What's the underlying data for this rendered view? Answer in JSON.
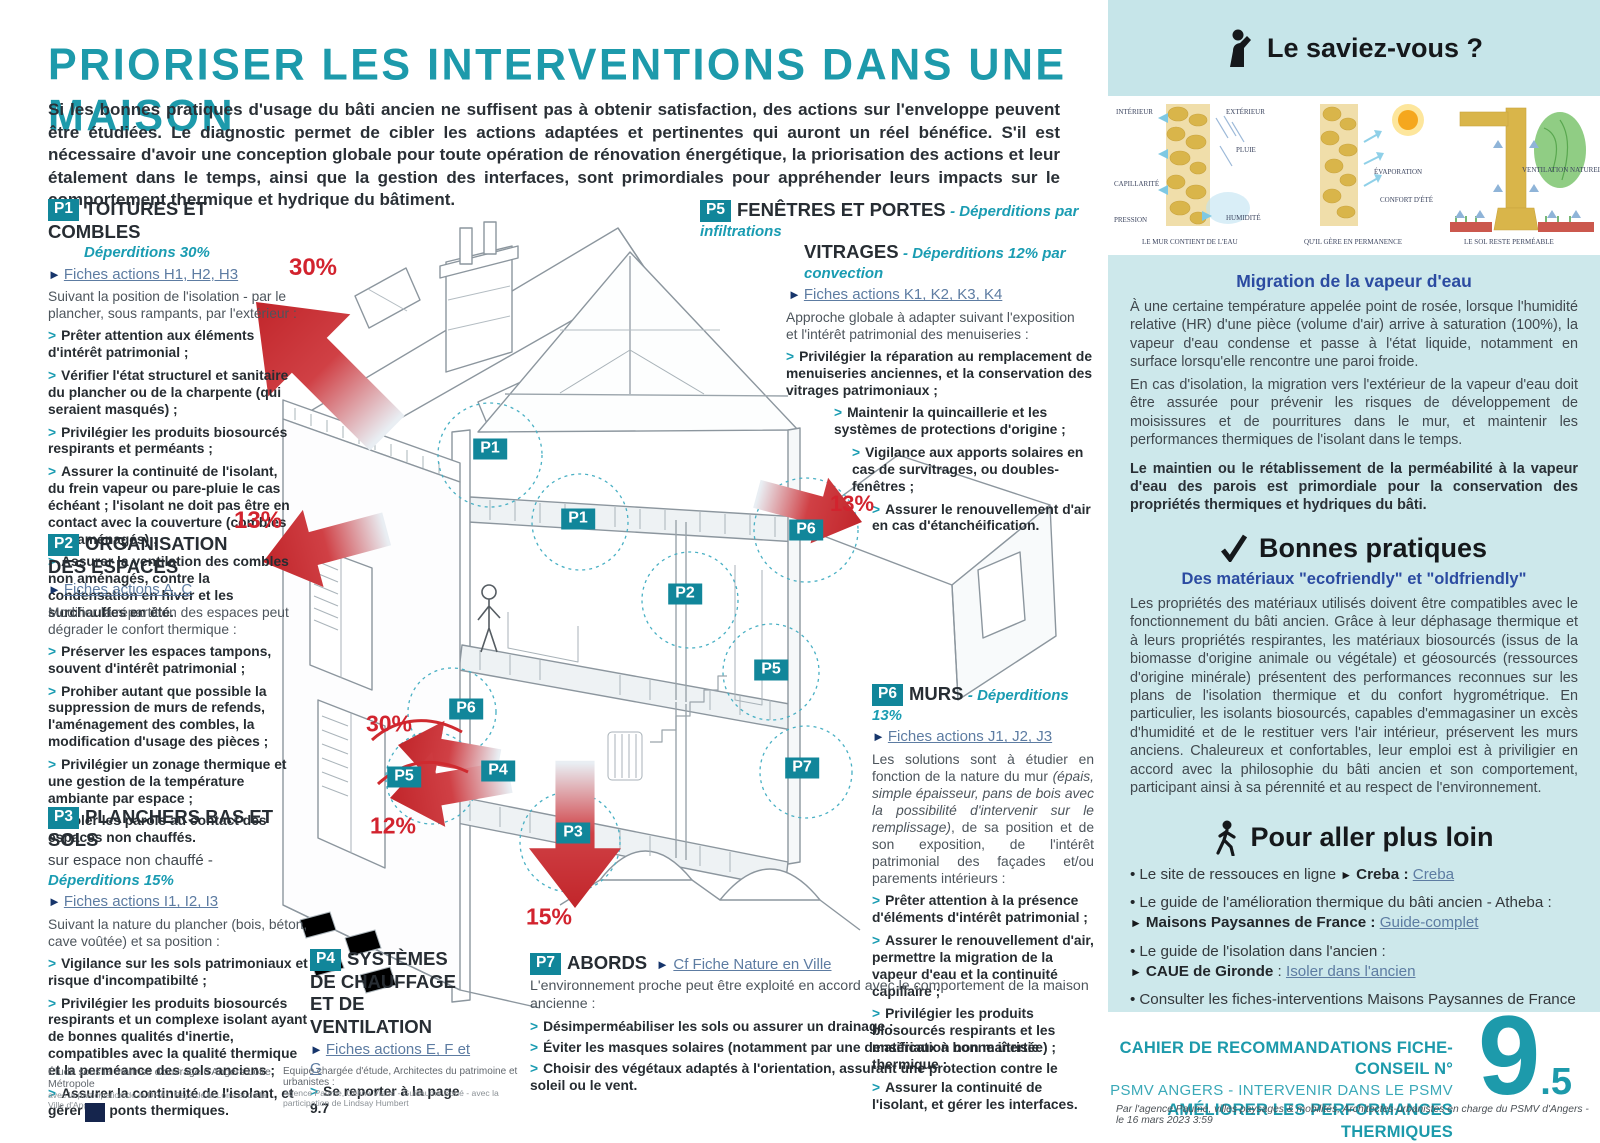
{
  "header": {
    "title": "PRIORISER LES INTERVENTIONS DANS UNE MAISON",
    "intro": "Si les bonnes pratiques d'usage du bâti ancien ne suffisent pas à obtenir satisfaction, des actions sur l'enveloppe peuvent être étudiées. Le diagnostic permet de cibler les actions adaptées et pertinentes qui auront un réel bénéfice. S'il est nécessaire d'avoir une conception globale pour toute opération de rénovation énergétique, la priorisation des actions et leur étalement dans le temps, ainsi que la gestion des interfaces, sont primordiales pour appréhender leurs impacts sur le comportement thermique et hydrique du bâtiment."
  },
  "sections": {
    "p1": {
      "badge": "P1",
      "title": "TOITURES ET COMBLES",
      "subtitle": "Déperditions 30%",
      "link": "Fiches actions H1, H2, H3",
      "lead": "Suivant la position de l'isolation - par le plancher, sous rampants, par l'extérieur :",
      "bullets": [
        "Prêter attention aux éléments d'intérêt patrimonial ;",
        "Vérifier l'état structurel et sanitaire du plancher ou de la charpente (qui seraient masqués) ;",
        "Privilégier les produits biosourcés respirants et perméants ;",
        "Assurer la continuité de l'isolant, du frein vapeur ou pare-pluie le cas échéant ; l'isolant ne doit pas être en contact avec la couverture (combles non aménagés) ;",
        "Assurer la ventilation des combles non aménagés, contre la condensation en hiver et les surchauffes en été."
      ]
    },
    "p2": {
      "badge": "P2",
      "title": "ORGANISATION DES ESPACES",
      "link": "Fiches actions A, C",
      "lead": "Modifier la répartition des espaces peut dégrader le confort thermique :",
      "bullets": [
        "Préserver les espaces tampons, souvent d'intérêt patrimonial ;",
        "Prohiber autant que possible la suppression de murs de refends, l'aménagement des combles, la modification d'usage des pièces ;",
        "Privilégier un zonage thermique et une gestion de la température ambiante par espace ;",
        "Isoler les parois au contact des espaces non chauffés."
      ]
    },
    "p3": {
      "badge": "P3",
      "title": "PLANCHERS BAS ET SOLS",
      "subtitle_plain": "sur espace non chauffé - ",
      "subtitle": "Déperditions 15%",
      "link": "Fiches actions I1, I2, I3",
      "lead": "Suivant la nature du plancher (bois, béton, cave voûtée) et sa position :",
      "bullets": [
        "Vigilance sur les sols patrimoniaux et risque d'incompatibilté ;",
        "Privilégier les produits biosourcés respirants et un complexe isolant ayant de bonnes qualités d'inertie, compatibles avec la qualité thermique et la perméance des sols anciens ;",
        "Assurer la continuité de l'isolant, et gérer les ponts thermiques."
      ]
    },
    "p4": {
      "badge": "P4",
      "title": "SYSTÈMES DE CHAUFFAGE ET DE VENTILATION",
      "link": "Fiches actions E, F et G",
      "bullets": [
        "Se reporter à la page 9.7"
      ]
    },
    "p5": {
      "badge": "P5",
      "title": "FENÊTRES ET PORTES",
      "subtitle": "- Déperditions par infiltrations",
      "title2": "VITRAGES",
      "subtitle2": "- Déperditions 12% par convection",
      "link": "Fiches actions K1, K2, K3, K4",
      "lead": "Approche globale à adapter suivant l'exposition et l'intérêt patrimonial des menuiseries :",
      "bullets": [
        "Privilégier la réparation au remplacement de menuiseries anciennes, et la conservation des vitrages patrimoniaux ;",
        "Maintenir la quincaillerie et les systèmes de protections d'origine ;",
        "Vigilance aux apports solaires en cas de survitrages, ou doubles-fenêtres ;",
        "Assurer le renouvellement d'air en cas d'étanchéification."
      ]
    },
    "p6": {
      "badge": "P6",
      "title": "MURS",
      "subtitle": "- Déperditions 13%",
      "link": "Fiches actions J1, J2, J3",
      "lead_pre": "Les solutions sont à étudier en fonction de la nature du mur ",
      "lead_italic": "(épais, simple épaisseur, pans de bois avec la possibilité d'intervenir sur le remplissage)",
      "lead_post": ", de sa position et de son exposition, de l'intérêt patrimonial des façades et/ou parements intérieurs :",
      "bullets": [
        "Prêter attention à la présence d'éléments d'intérêt patrimonial ;",
        "Assurer le renouvellement d'air, permettre la migration de la vapeur d'eau et la continuité capillaire ;",
        "Privilégier les produits biosourcés respirants et les matériaux à bonne inertie thermique ;",
        "Assurer la continuité de l'isolant, et gérer les interfaces."
      ]
    },
    "p7": {
      "badge": "P7",
      "title": "ABORDS",
      "link": "Cf Fiche Nature en Ville",
      "lead": "L'environnement proche peut être exploité en accord avec le comportement de la maison ancienne :",
      "bullets": [
        "Désimperméabiliser les sols ou assurer un drainage ;",
        "Éviter les masques solaires (notamment par une densification non maîtrisée) ;",
        "Choisir des végétaux adaptés à l'orientation, assurant une protection contre le soleil ou le vent."
      ]
    }
  },
  "diagram": {
    "markers": [
      {
        "label": "P1"
      },
      {
        "label": "P1"
      },
      {
        "label": "P2"
      },
      {
        "label": "P6"
      },
      {
        "label": "P5"
      },
      {
        "label": "P6"
      },
      {
        "label": "P5"
      },
      {
        "label": "P4"
      },
      {
        "label": "P3"
      },
      {
        "label": "P7"
      }
    ],
    "losses": [
      {
        "value": "30%"
      },
      {
        "value": "13%"
      },
      {
        "value": "13%"
      },
      {
        "value": "30%"
      },
      {
        "value": "12%"
      },
      {
        "value": "15%"
      }
    ]
  },
  "sidebar": {
    "know": {
      "title": "Le saviez-vous ?",
      "illus1": {
        "labels": [
          "INTÉRIEUR",
          "EXTÉRIEUR",
          "PLUIE",
          "CAPILLARITÉ",
          "PRESSION",
          "HUMIDITÉ"
        ],
        "caption": "LE MUR CONTIENT DE L'EAU"
      },
      "illus2": {
        "labels": [
          "ÉVAPORATION",
          "CONFORT D'ÉTÉ"
        ],
        "caption": "QU'IL GÈRE EN PERMANENCE"
      },
      "illus3": {
        "labels": [
          "VENTILATION NATURELLE"
        ],
        "caption": "LE SOL RESTE PERMÉABLE"
      }
    },
    "migration": {
      "title": "Migration de la vapeur d'eau",
      "para1": "À une certaine température appelée point de rosée, lorsque l'humidité relative (HR) d'une pièce (volume d'air) arrive  à saturation (100%), la vapeur d'eau condense et passe à l'état liquide, notamment en surface lorsqu'elle rencontre une paroi froide.",
      "para2": "En cas d'isolation, la migration vers l'extérieur de la vapeur d'eau doit être assurée pour prévenir les risques de développement de moisissures et de pourritures dans le mur, et maintenir les performances thermiques de l'isolant dans le temps.",
      "bold": "Le maintien ou le rétablissement de la perméabilité à la vapeur d'eau des parois est primordiale pour la conservation des propriétés thermiques et hydriques du bâti."
    },
    "practices": {
      "title": "Bonnes pratiques",
      "subtitle": "Des matériaux \"ecofriendly\" et \"oldfriendly\"",
      "body": "Les propriétés des matériaux utilisés doivent être compatibles avec le fonctionnement du bâti ancien. Grâce à leur déphasage thermique et à leurs propriétés respirantes, les matériaux biosourcés (issus de la biomasse d'origine animale ou végétale) et géosourcés (ressources d'origine minérale) présentent des performances reconnues sur les plans de l'isolation thermique et du confort hygrométrique. En particulier, les isolants biosourcés, capables d'emmagasiner un excès d'humidité et de le restituer vers l'air intérieur, préservent les murs anciens. Chaleureux et confortables, leur emploi est à priviligier en accord avec la philosophie du bâti ancien et son comportement, participant ainsi à sa pérennité et au respect de l'environnement."
    },
    "further": {
      "title": "Pour aller plus loin",
      "items": [
        {
          "intro": "Le site de ressouces en ligne",
          "bold": "Creba :",
          "link": "Creba"
        },
        {
          "intro": "Le guide de l'amélioration thermique du bâti ancien - Atheba :",
          "bold": "Maisons Paysannes de France :",
          "link": "Guide-complet"
        },
        {
          "intro": "Le guide de l'isolation dans l'ancien :",
          "bold": "CAUE de Gironde",
          "sep": " : ",
          "link": "Isoler dans l'ancien"
        },
        {
          "intro": "Consulter les fiches-interventions Maisons Paysannes de France",
          "bold": "Atheba :",
          "link": "Fiches-interventions"
        }
      ],
      "note1": "Pour connaître les prescriptions opposables,",
      "note2": "se reporter au Règlement du PSMV (Article US5)"
    },
    "footer": {
      "line1": "CAHIER DE RECOMMANDATIONS FICHE-CONSEIL N°",
      "line2": "PSMV ANGERS  - INTERVENIR DANS LE PSMV",
      "line3": "AMÉLIORER LES PERFORMANCES THERMIQUES",
      "number": "9",
      "number_suffix": ".5",
      "credit": "Par l'agence Paume, villes paysages & mobilités, Architectes-urbanistes en charge du PSMV d'Angers - le 16 mars 2023 3:59"
    }
  },
  "credits": {
    "c1l1": "Étude sous la maîtrise d'ouvrage d'Angers Loire Métropole",
    "c1l2": "avec la participation de la DRAC Pays de la Loire et de la Ville d'Angers",
    "c2l1": "Equipe chargée d'étude, Architectes du patrimoine et urbanistes :",
    "c2l2": "Agence Paume, Céline Viaud - Guillaume Boué - avec la participation de Lindsay Humbert"
  }
}
